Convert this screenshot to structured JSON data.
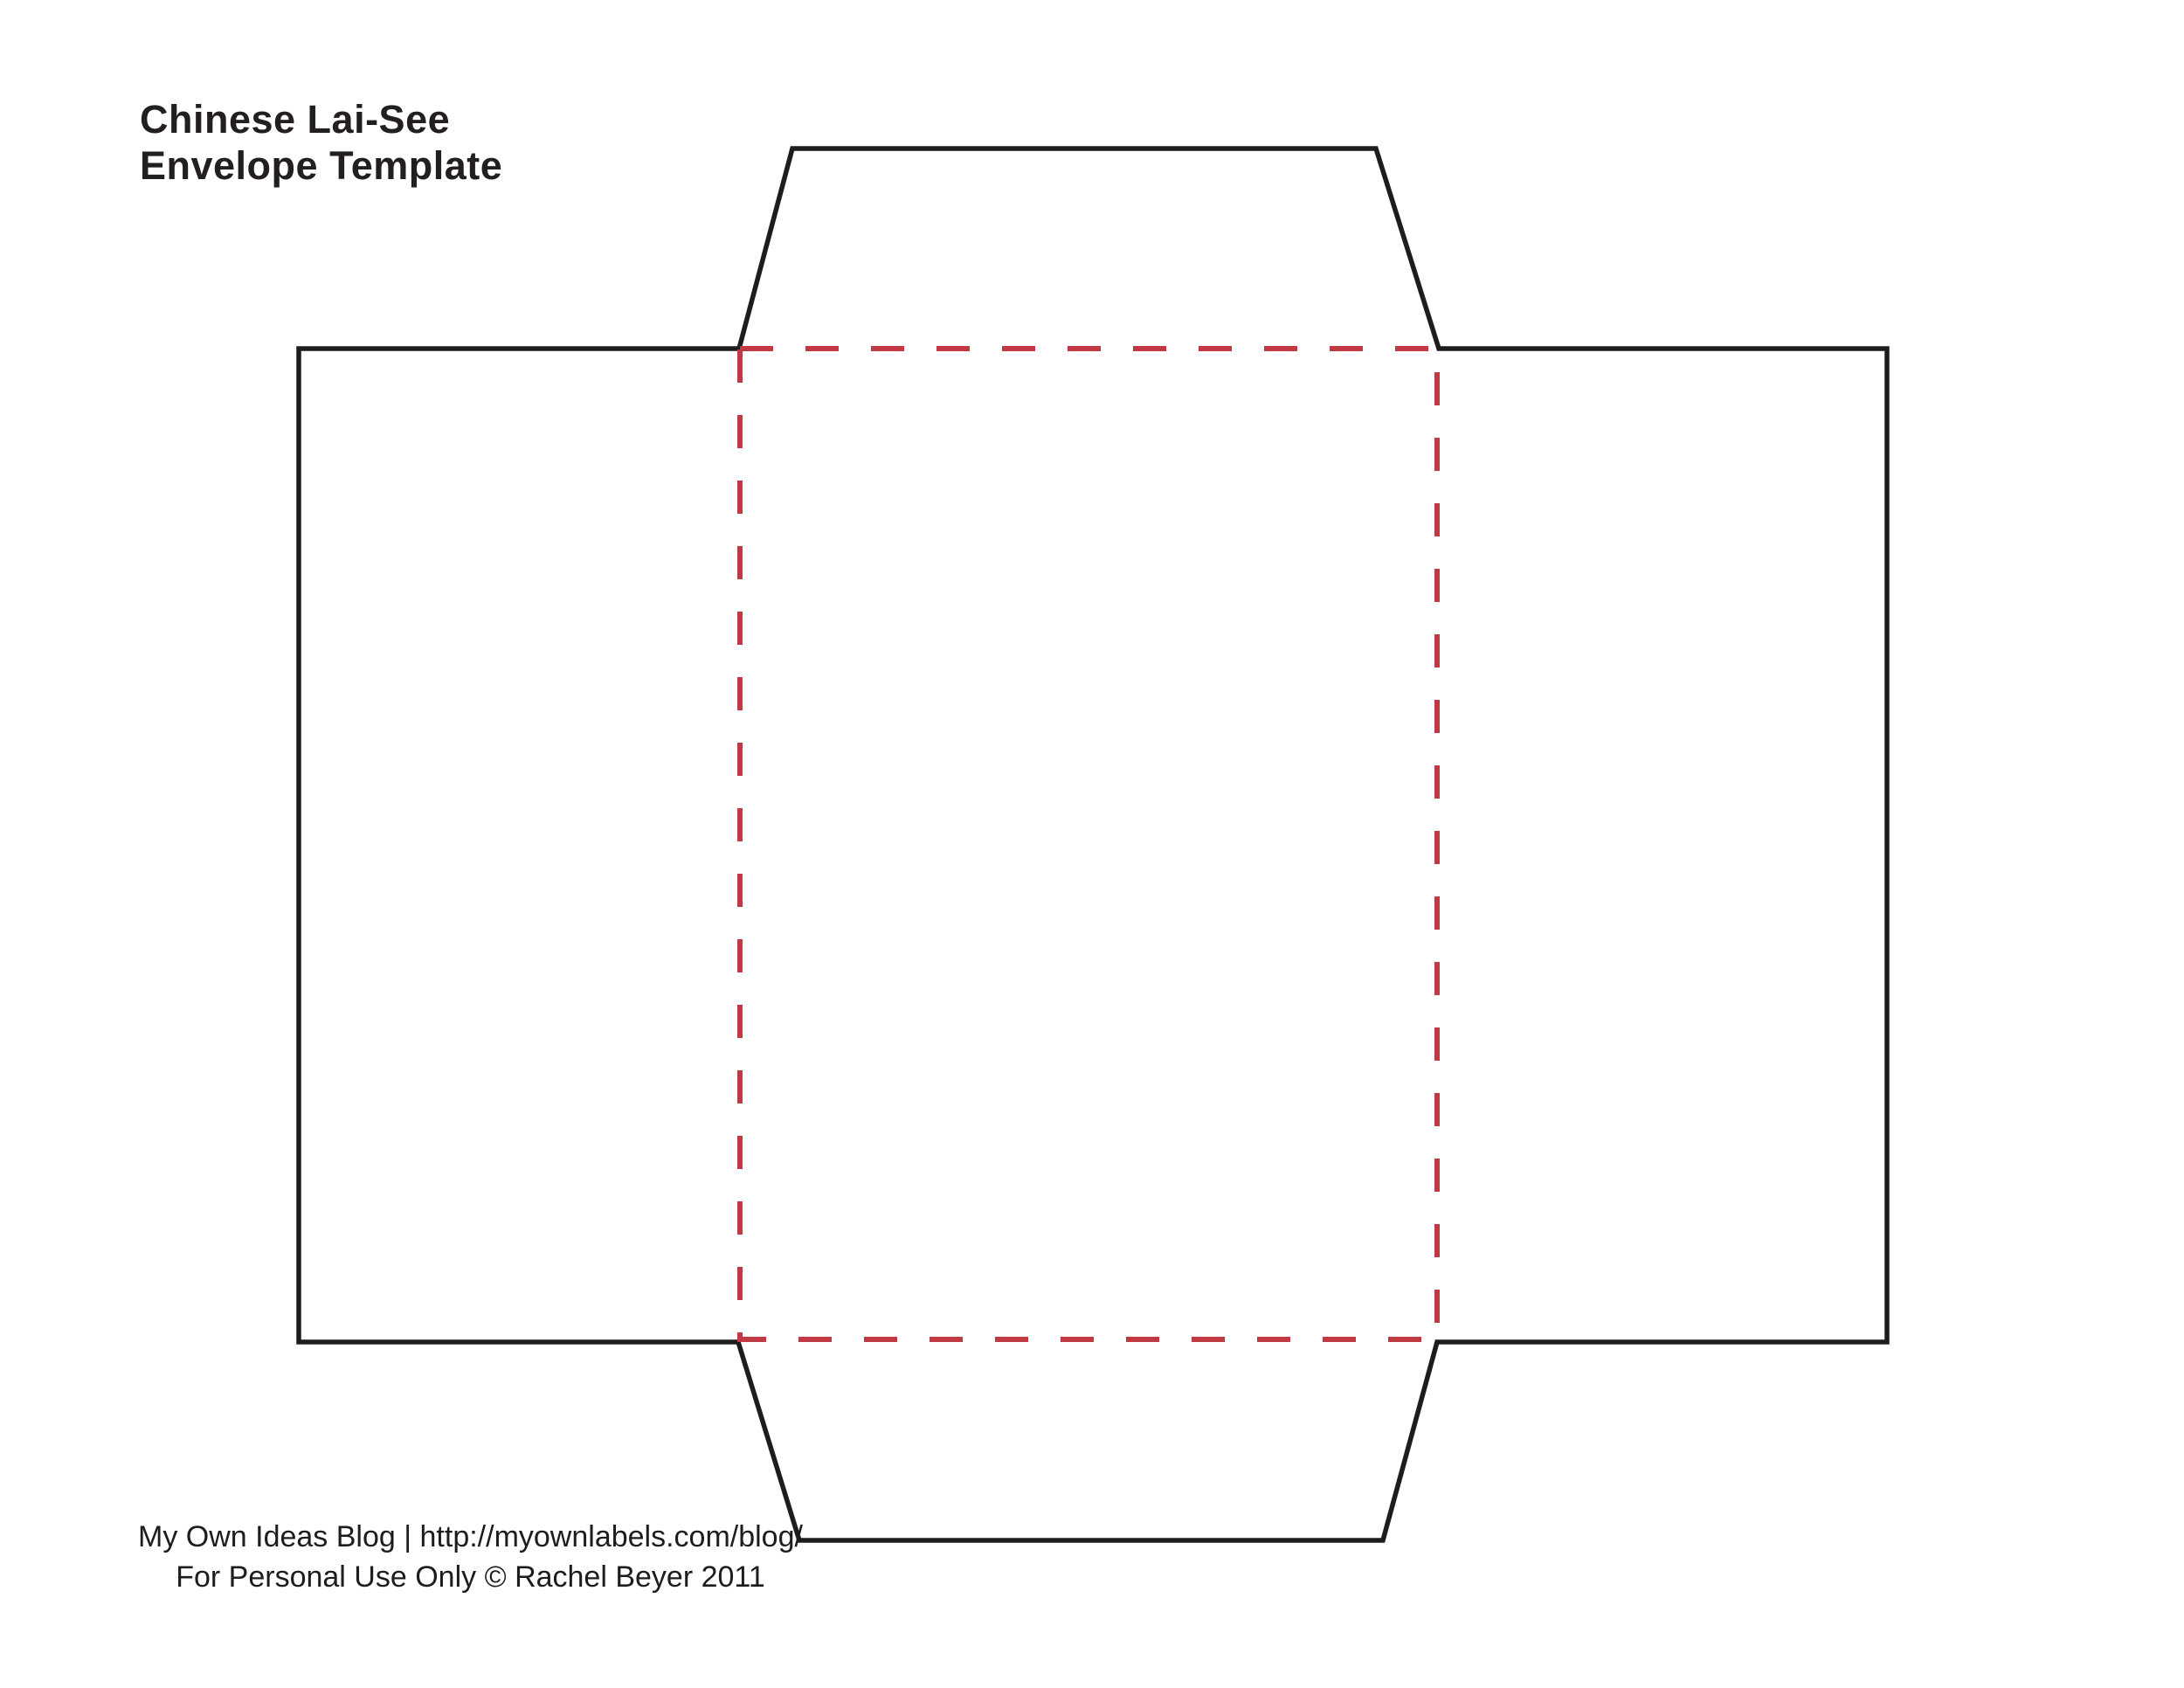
{
  "title": {
    "line1": "Chinese Lai-See",
    "line2": "Envelope Template"
  },
  "footer": {
    "line1": "My Own Ideas Blog | http://myownlabels.com/blog/",
    "line2": "For Personal Use Only © Rachel Beyer 2011"
  },
  "colors": {
    "background": "#FFFFFF",
    "outline": "#1E1C1C",
    "fold_line": "#C13A43",
    "title_text": "#231F20",
    "footer_text": "#1E1C1C"
  }
}
